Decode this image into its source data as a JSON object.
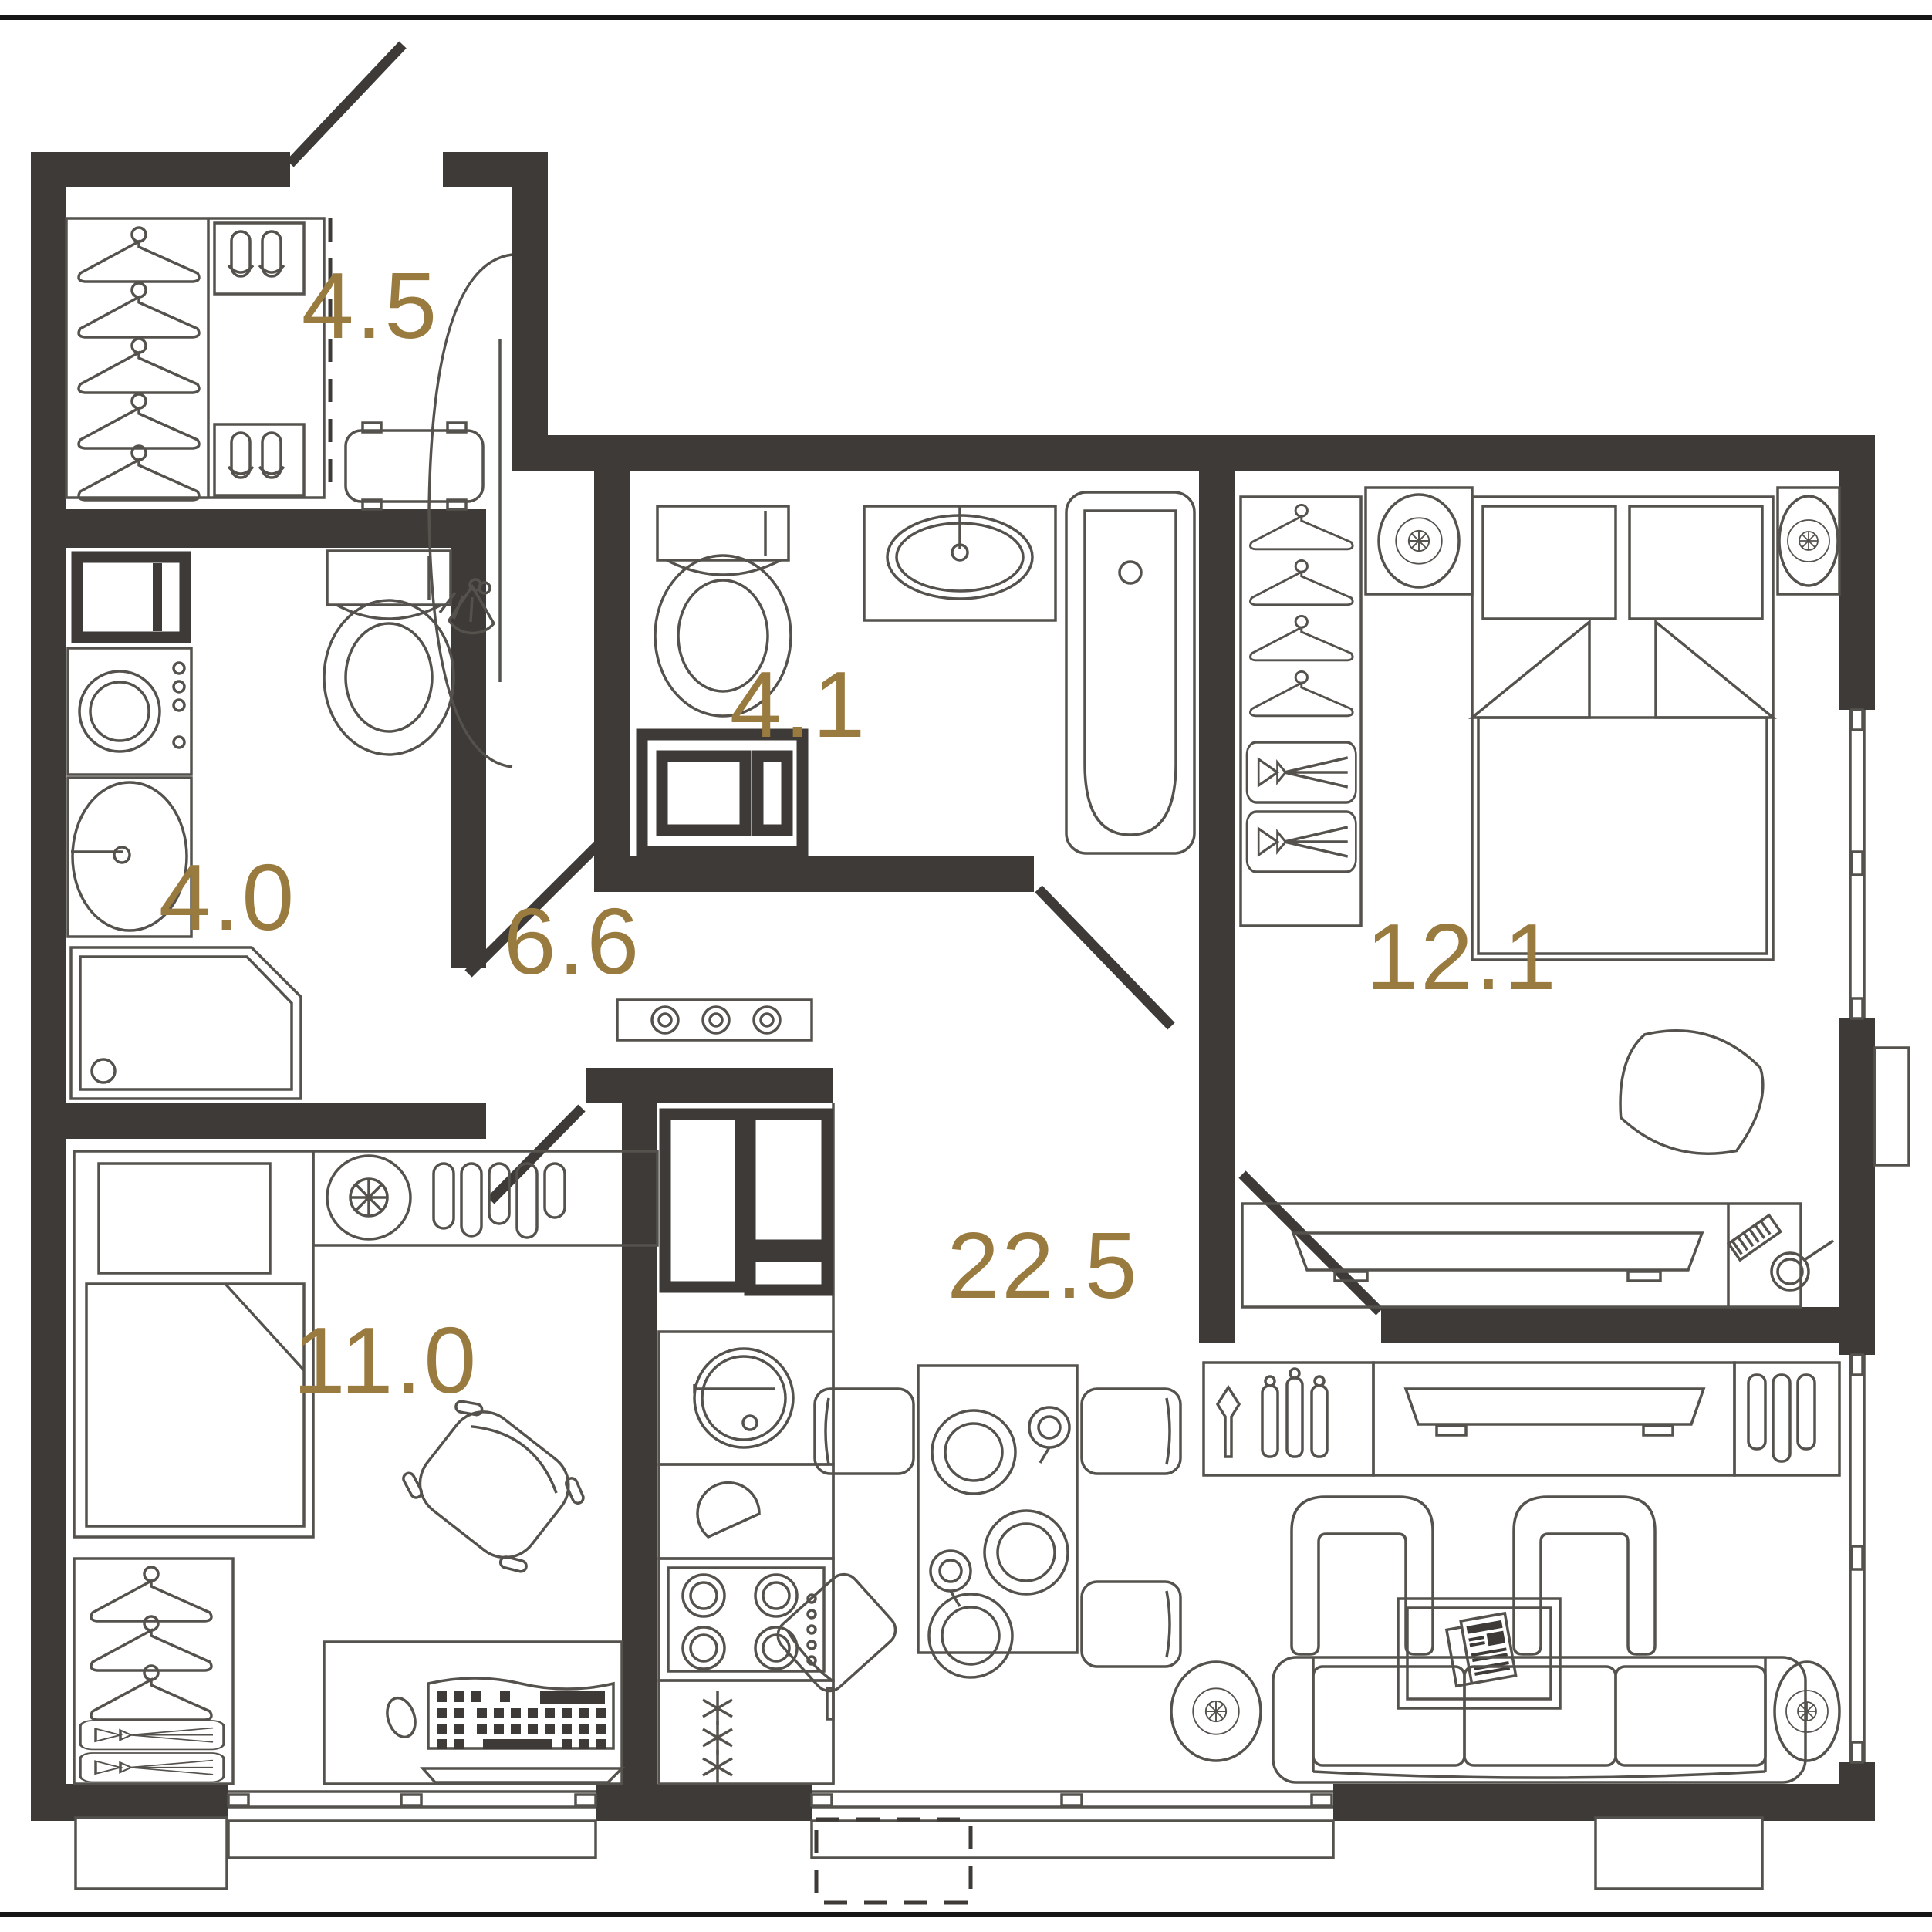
{
  "meta": {
    "type": "apartment-floor-plan",
    "area_units": "m2"
  },
  "colors": {
    "wall": "#3d3a37",
    "furniture_stroke": "#55524e",
    "label": "#9a7b3f",
    "background": "#ffffff"
  },
  "rooms": {
    "hallway": {
      "area": "4.5"
    },
    "shower_bath": {
      "area": "4.0"
    },
    "main_bath": {
      "area": "4.1"
    },
    "corridor": {
      "area": "6.6"
    },
    "bedroom": {
      "area": "12.1"
    },
    "second_room": {
      "area": "11.0"
    },
    "living_kitchen": {
      "area": "22.5"
    }
  },
  "icons": {
    "hanger": "clothes-hanger",
    "slippers": "slipper-pair",
    "bench": "entry-bench",
    "mirror": "wall-mirror-with-sconce",
    "washing_machine": "washing-machine",
    "sink": "wash-basin",
    "shower": "corner-shower-tray",
    "toilet": "toilet",
    "bathtub": "bathtub",
    "fridge": "refrigerator",
    "cooktop": "4-burner-cooktop",
    "freezer": "freezer-snowflakes",
    "dining_table": "dining-table-with-plates",
    "chair": "chair",
    "armchair": "armchair",
    "sofa": "three-seat-sofa",
    "coffee_table": "coffee-table-with-newspaper",
    "tv": "tv-console",
    "bar": "bar-bottles",
    "glasses": "glass-rack",
    "bed_double": "double-bed",
    "bed_single": "single-bed",
    "ceiling_light": "ceiling-light",
    "desk": "desk-with-keyboard",
    "balcony": "balcony-outline",
    "window": "window",
    "door": "door-swing"
  }
}
